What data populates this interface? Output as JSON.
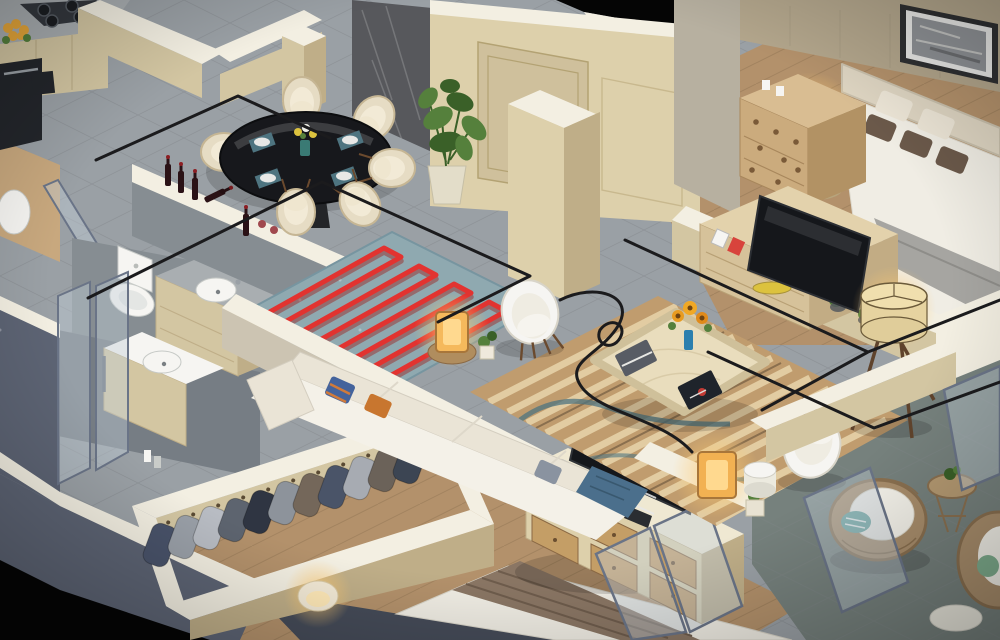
{
  "meta": {
    "title": "3D isometric cutaway floor plan render of a furnished apartment",
    "view": "isometric dollhouse top-down",
    "no_visible_text": true
  },
  "palette": {
    "void": "#050505",
    "slate": "#5d6474",
    "slateDark": "#454b58",
    "marbleFloor": "#9aa0a5",
    "tileLine": "#84898e",
    "bathTile": "#868d92",
    "bathTileDark": "#767d84",
    "woodFloor": "#b3916b",
    "woodLight": "#c8a87e",
    "plankLine": "#8f714f",
    "wallCream": "#d3c6a2",
    "wallCreamDark": "#bfae88",
    "wallTop": "#f3efe2",
    "cream2": "#ddd0ab",
    "doorCream": "#cfc09c",
    "wallBeige": "#ccc4b2",
    "wallBeige2": "#b7b0a0",
    "fabricWall": "#b3a68c",
    "marblePanel": "#57585c",
    "counter": "#a9aeb1",
    "stove": "#34383e",
    "dark": "#23262b",
    "rugTeal": "#8fa9b0",
    "coilRed": "#e23330",
    "coilRedDark": "#9c1f1d",
    "rugStripe": "#c09c6e",
    "rugStripeLight": "#e6d2a8",
    "rugWave": "#4e7480",
    "sofa": "#eae4d6",
    "sofaLight": "#f4f1e8",
    "chair": "#e6dcc4",
    "chairInner": "#f2ead6",
    "tableGlass": "#17181c",
    "teal": "#4e7480",
    "blue": "#44639c",
    "orange": "#c8762f",
    "gold": "#c9a84c",
    "yellow": "#dcc23e",
    "green": "#55803c",
    "greenDark": "#3a6028",
    "glow": "#ffdf9e",
    "lampShade": "#ecd9a4",
    "bedWhite": "#f0ede4",
    "bedGray": "#a6a5a1",
    "pillowBrown": "#6b594a",
    "headboard": "#ded5c2",
    "furnWood": "#c3a06c",
    "furnWoodDark": "#8a6844",
    "drawerWood": "#c49e66",
    "wicker": "#a98e6c",
    "glassTint": "rgba(195,208,218,0.42)",
    "glassFrame": "#6a7487",
    "wire": "#1b1b1d",
    "white": "#f6f5f2",
    "tvBlack": "#15171b",
    "artGray": "#8f9296",
    "balcony": "#76817d"
  },
  "scene": {
    "rooms": [
      {
        "id": "kitchen",
        "label": "Kitchen",
        "items": [
          "gas-cooktop",
          "built-in-oven",
          "cream-cabinets",
          "marble-top-bar",
          "yellow-flowers",
          "coffee-maker"
        ]
      },
      {
        "id": "dining-area",
        "label": "Dining area",
        "items": [
          "round-black-glass-table",
          "cream-upholstered-chairs",
          "teal-place-settings",
          "flower-vase",
          "monstera-plant",
          "dark-marble-feature-wall"
        ]
      },
      {
        "id": "entry",
        "label": "Entry",
        "items": [
          "cream-paneled-door",
          "gold-door-handles",
          "marble-wall",
          "ceiling-cutout"
        ]
      },
      {
        "id": "bathroom-main",
        "label": "Main bathroom",
        "items": [
          "toilet",
          "vanity-with-round-sink",
          "gray-stone-tiling",
          "wine-bottles-on-wall-top"
        ]
      },
      {
        "id": "bathroom-second",
        "label": "Second bathroom",
        "items": [
          "vanity-with-round-sink",
          "glass-shower-enclosure"
        ]
      },
      {
        "id": "walk-in-closet",
        "label": "Walk-in closet",
        "items": [
          "hanging-jackets-row",
          "cream-wardrobe-walls",
          "glowing-table-lamp"
        ]
      },
      {
        "id": "living-room",
        "label": "Living room",
        "items": [
          "cream-sectional-sofa",
          "striped-area-rug",
          "marble-coffee-table",
          "sunflower-vase",
          "books",
          "white-armchair",
          "cube-lamps",
          "potted-plants"
        ]
      },
      {
        "id": "second-bedroom",
        "label": "Second bedroom",
        "items": [
          "bed-with-brown-runner",
          "six-drawer-tv-console",
          "flat-screen-tv",
          "photo-frame",
          "glass-balcony-door"
        ]
      },
      {
        "id": "master-bedroom",
        "label": "Master bedroom",
        "items": [
          "double-bed",
          "cream-headboard",
          "panoramic-artwork",
          "nightstand-with-lit-lamp",
          "perforated-dresser",
          "tv-stand-with-tv",
          "picture-frames",
          "yellow-bowl",
          "tripod-floor-lamp"
        ]
      },
      {
        "id": "balcony",
        "label": "Balcony",
        "items": [
          "rattan-armchair",
          "teal-striped-pillow",
          "wire-side-table",
          "glass-balustrade",
          "stone-floor"
        ]
      }
    ],
    "overlays": [
      {
        "id": "electrical-wiring",
        "label": "Black cable routing drawn on floors",
        "color_key": "wire"
      },
      {
        "id": "underfloor-heating-coil",
        "label": "Red serpentine heating coil over teal rug",
        "color_key": "coilRed"
      }
    ]
  }
}
